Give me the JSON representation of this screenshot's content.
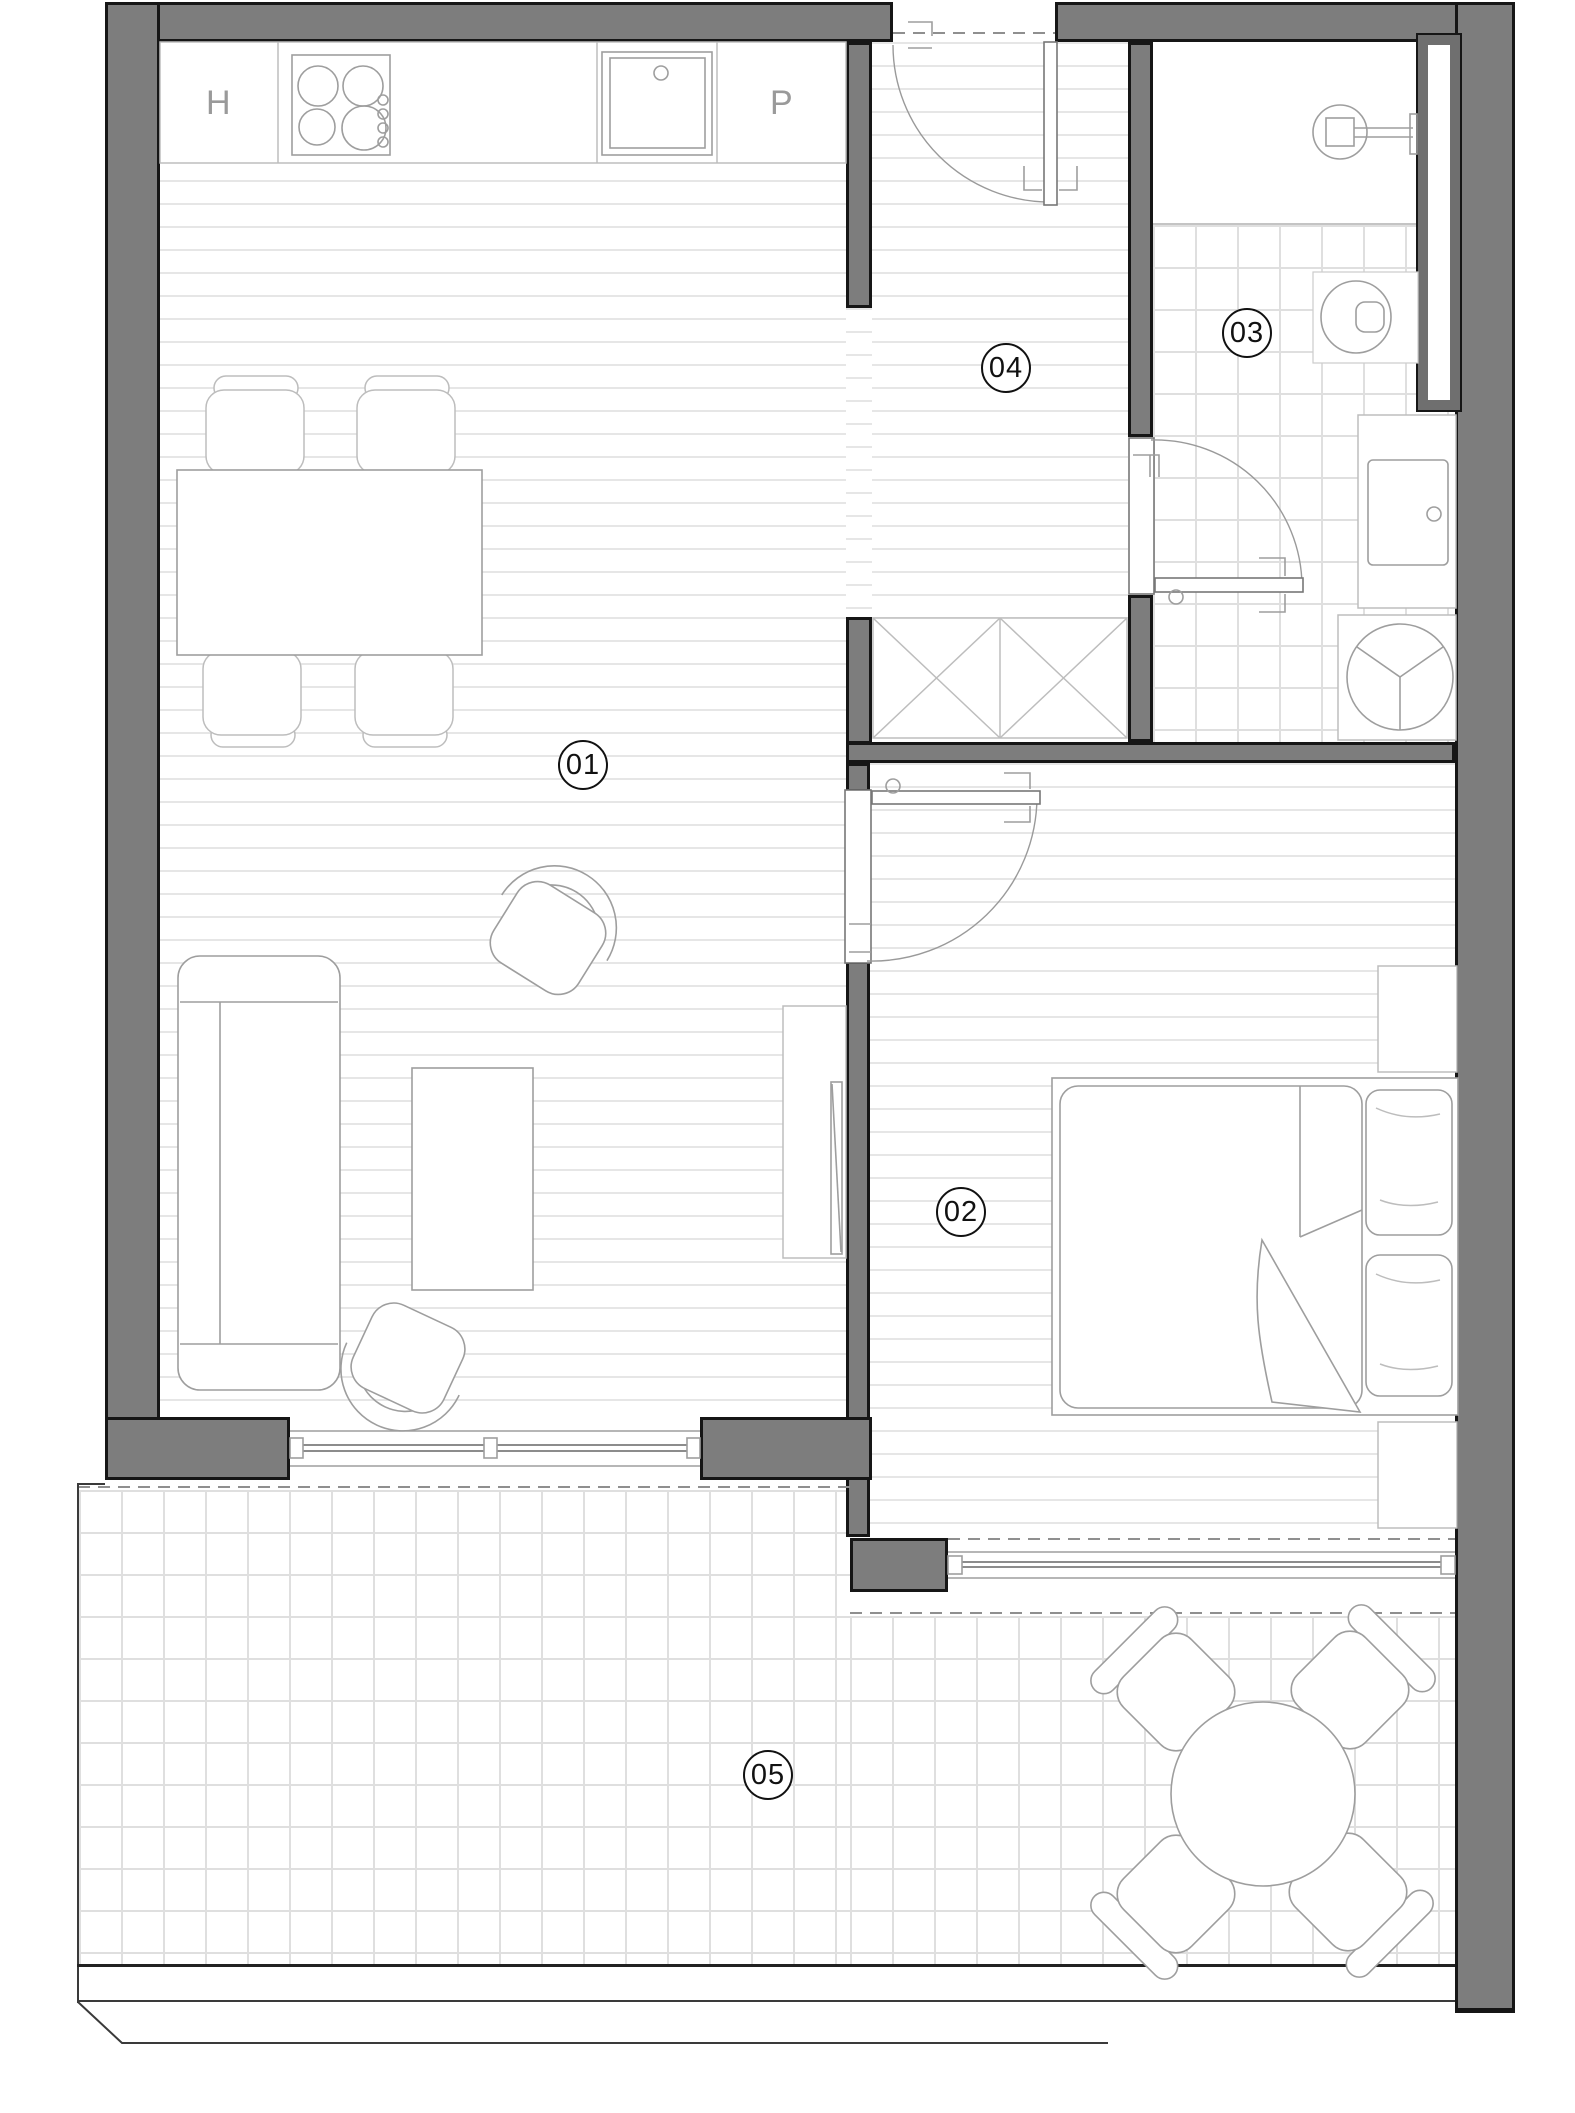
{
  "rooms": {
    "living": {
      "label": "01"
    },
    "bedroom": {
      "label": "02"
    },
    "bathroom": {
      "label": "03"
    },
    "hall": {
      "label": "04"
    },
    "balcony": {
      "label": "05"
    }
  },
  "kitchen": {
    "left_unit_label": "H",
    "right_unit_label": "P"
  },
  "colors": {
    "wall": "#7d7d7d",
    "wall_edge": "#161616",
    "shaft_inner": "#6f6f6f",
    "furn": "#9e9e9e",
    "furn_light": "#bdbdbd",
    "hatch": "#e6e6e6",
    "tile": "#dfdfdf",
    "dash": "#8f8f8f",
    "thin": "#3a3a3a",
    "text_gray": "#9a9a9a",
    "ink": "#111111"
  }
}
